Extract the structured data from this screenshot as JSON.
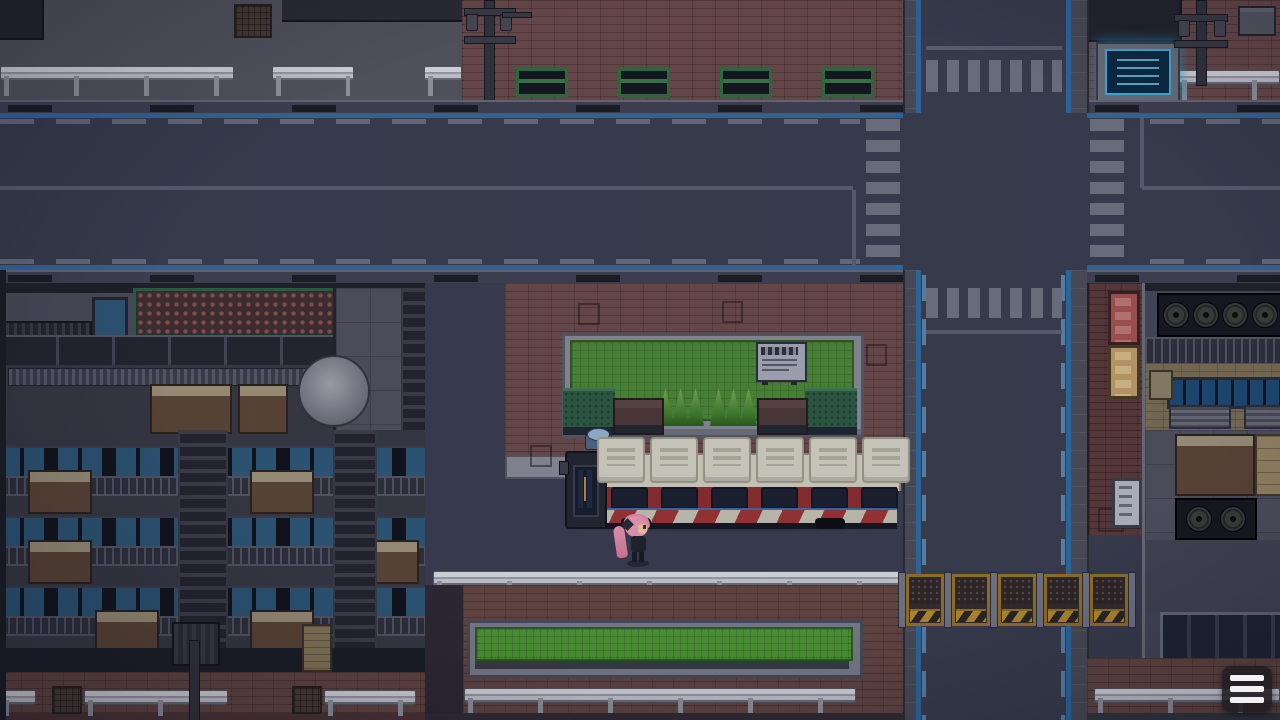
{
  "meta": {
    "scene_type": "top-down pixel-art city street, night",
    "viewport": "1280x720"
  },
  "hud": {
    "menu_button": {
      "icon": "hamburger-menu-icon",
      "tooltip": "Menu",
      "bar_count": 3
    }
  },
  "player": {
    "description": "girl with long pink ponytail, black ribbon, dark outfit",
    "facing": "right"
  },
  "vehicle": {
    "type": "city bus",
    "body_colors": [
      "cream",
      "dark red",
      "white"
    ],
    "roof_hatch_count": 6,
    "window_count": 6
  },
  "park": {
    "benches_green": 4,
    "benches_brown": 2,
    "topiary_groups": 2,
    "topiary_per_group": 3,
    "hedge_boxes": 2,
    "has_notice_board": true,
    "has_lawn": true
  },
  "roadworks": {
    "barrier_panels": 5
  },
  "signs": {
    "illuminated_board": {
      "color": "blue glow",
      "location": "top-right sidewalk"
    },
    "wall_signs": [
      "red",
      "yellow",
      "white"
    ]
  },
  "street": {
    "crosswalks": 4,
    "stop_lines": 4,
    "lane_edge_color": "#2e6ca3",
    "lane_dash_color": "#6b6e80",
    "center_line_color": "#5d6072"
  },
  "props": [
    "guardrails",
    "manhole covers",
    "utility poles",
    "satellite dish",
    "trash bin",
    "drain grates",
    "exhaust fans",
    "air conditioners"
  ],
  "palette": {
    "road": "#3a3d4e",
    "pavement": "#54565f",
    "brick": "#6e4b4b",
    "brick_dark": "#5c3a3a",
    "grass": "#4c8a36",
    "hedge": "#2d5b43",
    "stone": "#8b8e99",
    "bus_cream": "#d6d2c2",
    "bus_red": "#8c2e2e",
    "barrier_yellow": "#b8912f",
    "sign_glow": "#43b5e6",
    "hair_pink": "#e88fab"
  }
}
